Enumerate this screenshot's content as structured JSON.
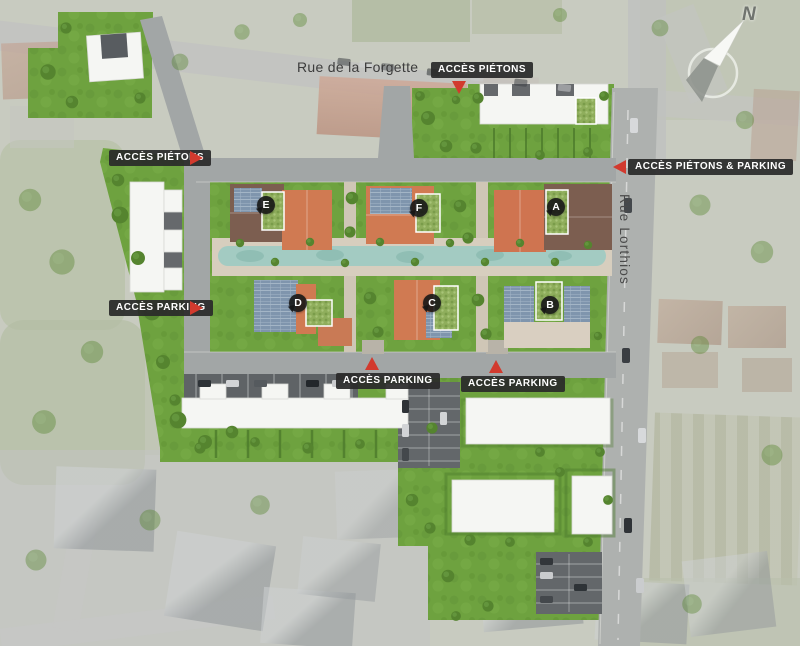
{
  "streets": {
    "forgette": "Rue de la Forgette",
    "lorthios": "Rue Lorthios"
  },
  "access": [
    {
      "id": "pietons-top",
      "text": "ACCÈS PIÉTONS",
      "arrow": "down"
    },
    {
      "id": "pietons-left",
      "text": "ACCÈS PIÉTONS",
      "arrow": "right"
    },
    {
      "id": "pietons-parking-right",
      "text": "ACCÈS PIÉTONS & PARKING",
      "arrow": "left"
    },
    {
      "id": "parking-left",
      "text": "ACCÈS PARKING",
      "arrow": "right"
    },
    {
      "id": "parking-bottom-west",
      "text": "ACCÈS PARKING",
      "arrow": "up"
    },
    {
      "id": "parking-bottom-east",
      "text": "ACCÈS PARKING",
      "arrow": "up"
    }
  ],
  "buildings": [
    {
      "letter": "A"
    },
    {
      "letter": "B"
    },
    {
      "letter": "C"
    },
    {
      "letter": "D"
    },
    {
      "letter": "E"
    },
    {
      "letter": "F"
    }
  ],
  "compass": {
    "north": "N"
  },
  "colors": {
    "accent_red": "#d23a2e",
    "badge_background": "#2a2a2a",
    "badge_text": "#ffffff",
    "lawn_green": "#6ea23f",
    "water_teal": "#a3cbc2",
    "roof_terracotta": "#d07a52",
    "roof_brown": "#7c5e50",
    "solar_panel_blue": "#7f95ad",
    "green_roof": "#8fae5c"
  }
}
